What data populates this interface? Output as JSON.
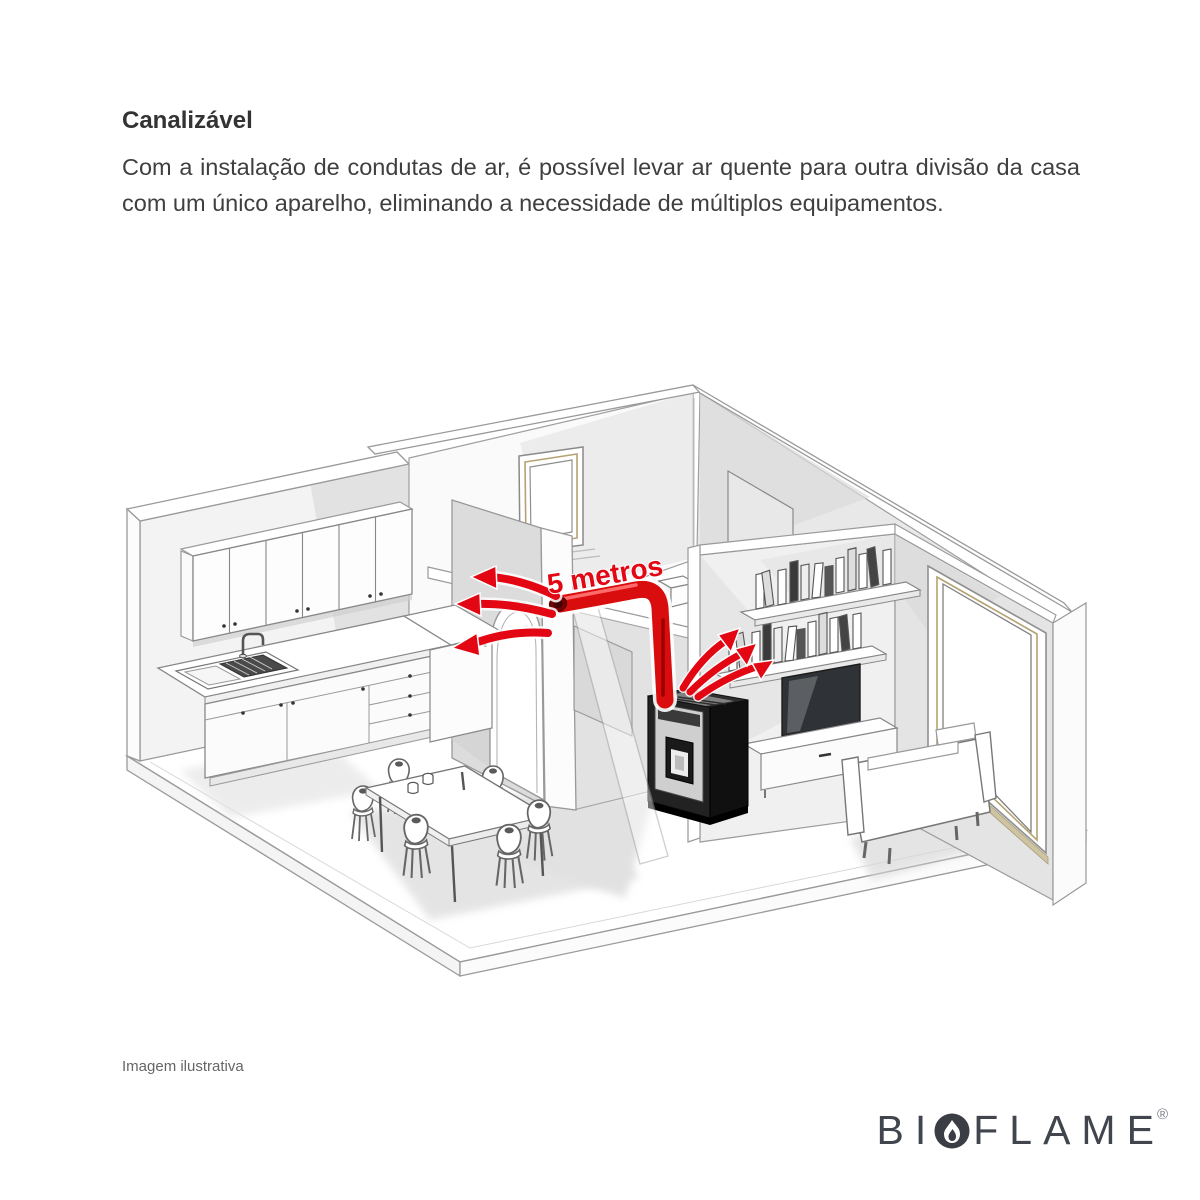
{
  "header": {
    "title": "Canalizável",
    "body": "Com a instalação de condutas de ar, é possível levar ar quente para outra divisão da casa com um único aparelho, eliminando a necessidade de múltiplos equipamentos."
  },
  "diagram": {
    "type": "isometric-house-cutaway",
    "duct_label": "5 metros",
    "rooms": [
      "cozinha",
      "hall",
      "sala"
    ],
    "elements": [
      "pellet-stove",
      "heat-duct",
      "arch-doorway",
      "kitchen-cabinets",
      "sink",
      "dining-table",
      "chairs",
      "sofa",
      "tv",
      "tv-bench",
      "book-shelves",
      "interior-window",
      "picture-window",
      "duct-outlet-box"
    ],
    "colors": {
      "accent_red": "#e30613",
      "dark_red": "#7d0000",
      "wall_gray": "#e2e2e2",
      "line_gray": "#8f8f8f",
      "frame_tan": "#b5a271",
      "stove_black": "#1c1c1c"
    }
  },
  "footer": {
    "note": "Imagem ilustrativa"
  },
  "logo": {
    "prefix": "BI",
    "suffix": "FLAME",
    "registered": "®",
    "flame_icon": "flame-in-circle",
    "color": "#41454e"
  }
}
